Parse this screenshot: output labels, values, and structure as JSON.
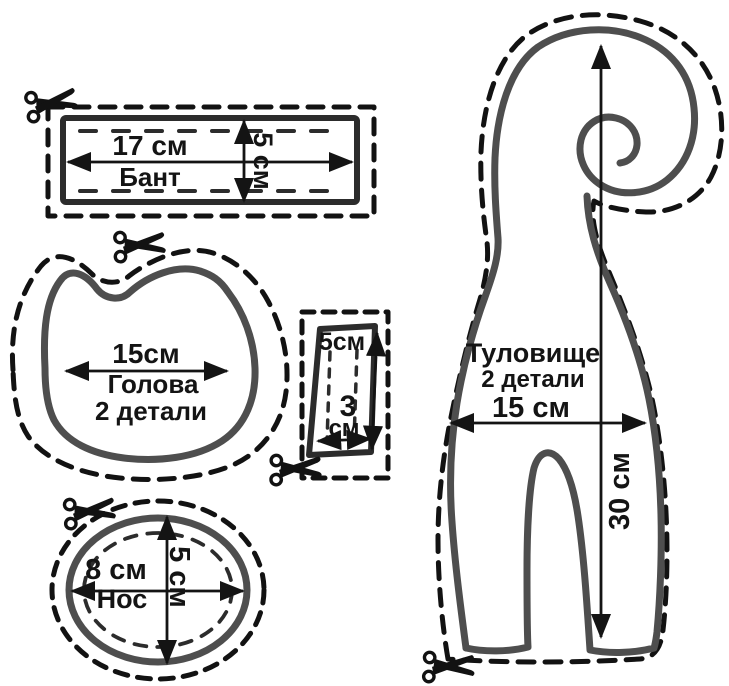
{
  "pieces": {
    "bow": {
      "name": "Бант",
      "width": "17 см",
      "height": "5 см"
    },
    "head": {
      "name": "Голова",
      "quantity": "2 детали",
      "width": "15см"
    },
    "strip": {
      "height": "5см",
      "width_value": "3",
      "width_unit": "см"
    },
    "nose": {
      "name": "Нос",
      "width": "8 см",
      "height": "5 см"
    },
    "body": {
      "name": "Туловище",
      "quantity": "2 детали",
      "width": "15 см",
      "height": "30 см"
    }
  },
  "icons": {
    "scissors": "scissors-icon"
  },
  "colors": {
    "background": "#ffffff",
    "fabric": "#ededee",
    "cut_line": "#121212",
    "sketch_line": "#4e4e4e",
    "stitch_line": "#2c2c2c",
    "text": "#141414"
  }
}
